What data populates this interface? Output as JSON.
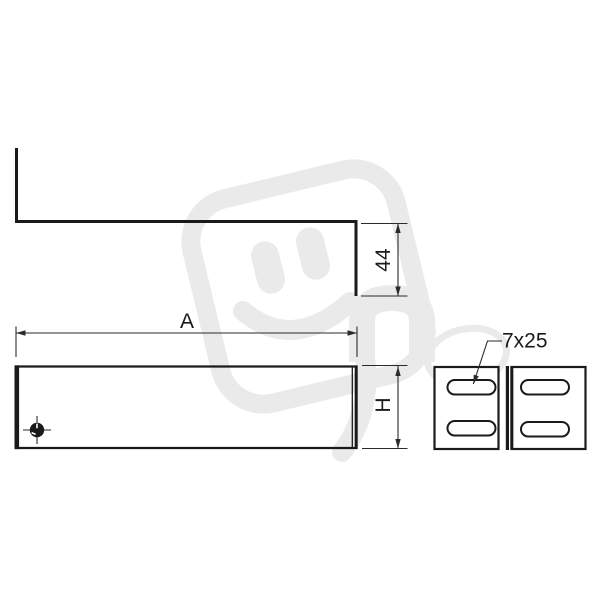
{
  "drawing": {
    "labels": {
      "flange_height": "44",
      "width": "A",
      "height": "H",
      "slot_size": "7x25"
    }
  },
  "watermark": {
    "icon": "happy-plug-logo"
  },
  "colors": {
    "line": "#1a1a1a",
    "dim": "#2b2b2b",
    "watermark": "#eaeaea",
    "background": "#ffffff"
  }
}
